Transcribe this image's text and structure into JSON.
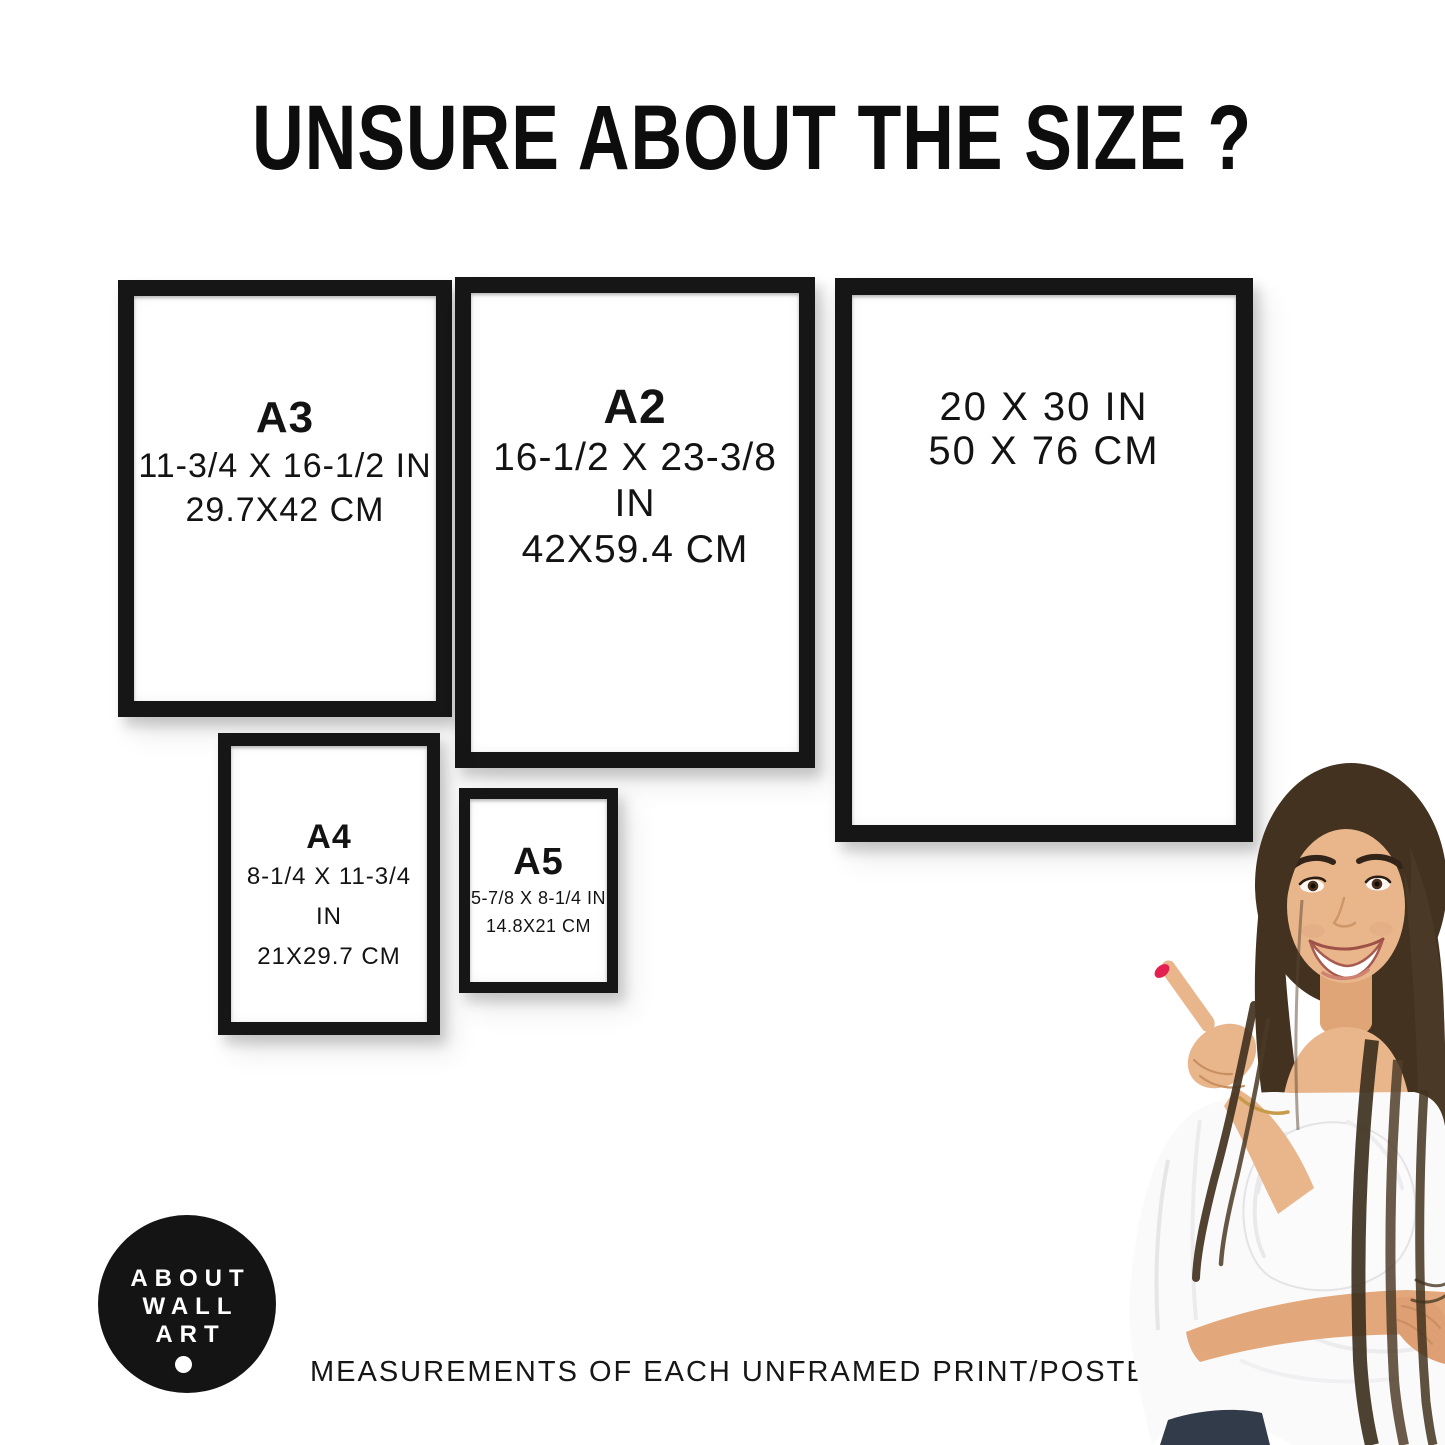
{
  "title": "UNSURE ABOUT THE SIZE ?",
  "frames": [
    {
      "name": "A3",
      "label": "A3",
      "inches": "11-3/4 X 16-1/2 IN",
      "cm": "29.7X42 CM"
    },
    {
      "name": "A2",
      "label": "A2",
      "inches": "16-1/2 X 23-3/8 IN",
      "cm": "42X59.4 CM"
    },
    {
      "name": "20x30in",
      "label": "",
      "inches": "20 X 30 IN",
      "cm": "50 X 76 CM"
    },
    {
      "name": "A4",
      "label": "A4",
      "inches": "8-1/4 X 11-3/4 IN",
      "cm": "21X29.7 CM"
    },
    {
      "name": "A5",
      "label": "A5",
      "inches": "5-7/8 X 8-1/4 IN",
      "cm": "14.8X21 CM"
    }
  ],
  "logo": {
    "line1": "ABOUT",
    "line2": "WALL",
    "line3": "ART"
  },
  "caption": "MEASUREMENTS OF EACH UNFRAMED PRINT/POSTER",
  "colors": {
    "background": "#ffffff",
    "frame_black": "#161616",
    "text": "#131313",
    "logo_bg": "#141414",
    "logo_text": "#ffffff",
    "nail_red": "#e42050",
    "hair_brown": "#42321f",
    "skin": "#e9b68c",
    "blouse_white": "#fafafa"
  }
}
